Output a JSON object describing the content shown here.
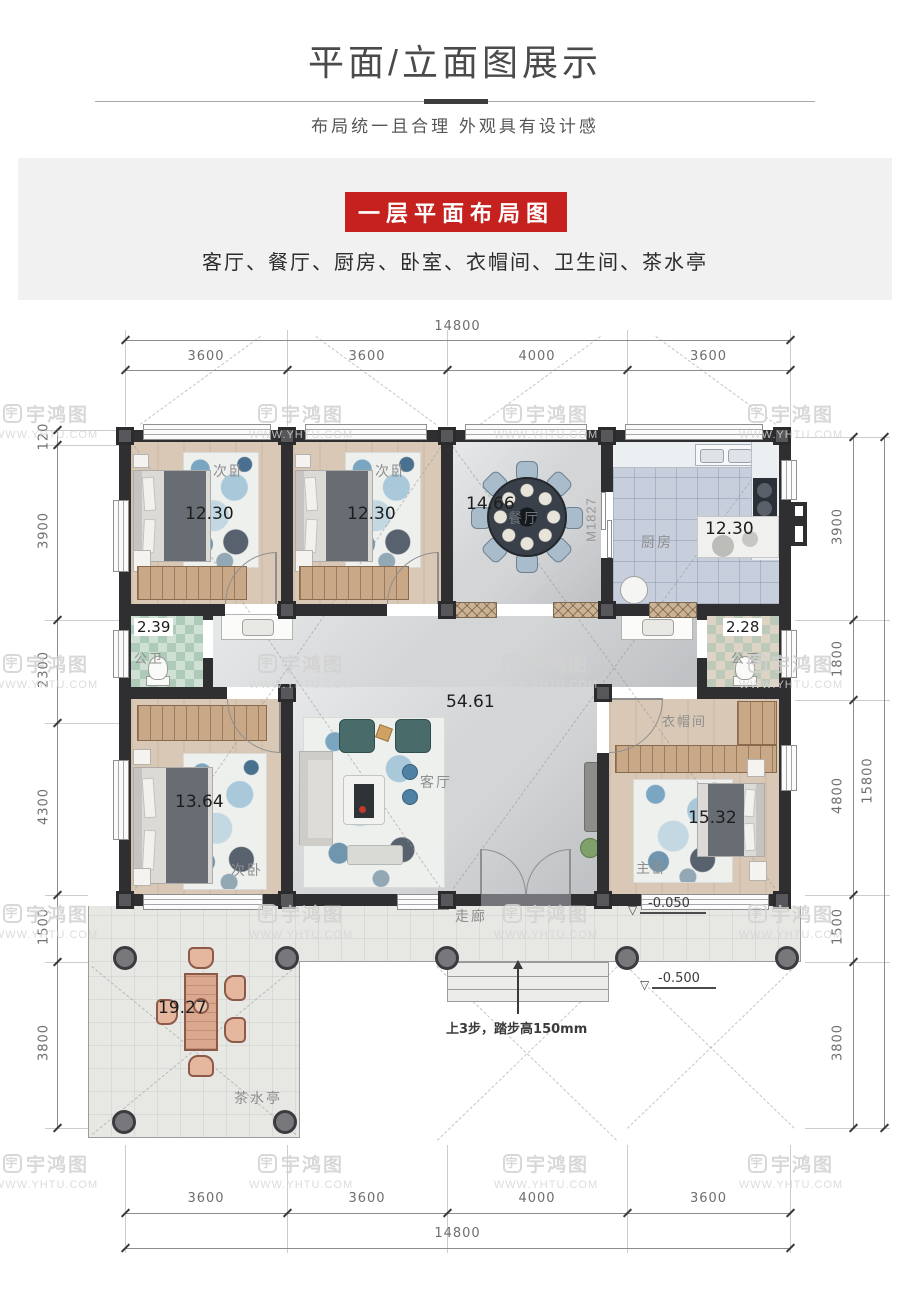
{
  "header": {
    "title": "平面/立面图展示",
    "subtitle": "布局统一且合理 外观具有设计感",
    "banner": "一层平面布局图",
    "room_list": "客厅、餐厅、厨房、卧室、衣帽间、卫生间、茶水亭"
  },
  "watermark": {
    "icon_char": "宇",
    "logo": "宇鸿图",
    "url": "WWW.YHTU.COM"
  },
  "dims": {
    "top": {
      "overall": "14800",
      "segments": [
        "3600",
        "3600",
        "4000",
        "3600"
      ]
    },
    "bottom": {
      "overall": "14800",
      "segments": [
        "3600",
        "3600",
        "4000",
        "3600"
      ]
    },
    "left": {
      "segments": [
        "120",
        "3900",
        "2300",
        "4300",
        "1500",
        "3800"
      ]
    },
    "right": {
      "segments": [
        "3900",
        "1800",
        "4800",
        "1500",
        "3800"
      ],
      "overall": "15800"
    }
  },
  "rooms": {
    "bedroom_a": {
      "name": "次卧",
      "area": "12.30"
    },
    "bedroom_b": {
      "name": "次卧",
      "area": "12.30"
    },
    "dining": {
      "name": "餐厅",
      "area": "14.66"
    },
    "kitchen": {
      "name": "厨房",
      "area": "12.30"
    },
    "bath_left": {
      "name": "公卫",
      "area": "2.39"
    },
    "bath_right": {
      "name": "公卫",
      "area": "2.28"
    },
    "living": {
      "name": "客厅",
      "area": "54.61"
    },
    "bedroom_c": {
      "name": "次卧",
      "area": "13.64"
    },
    "cloakroom": {
      "name": "衣帽间"
    },
    "master": {
      "name": "主卧",
      "area": "15.32"
    },
    "corridor": {
      "name": "走廊"
    },
    "tea_pavilion": {
      "name": "茶水亭",
      "area": "19.27"
    }
  },
  "annotations": {
    "door_code": "M1827",
    "level_porch": "-0.050",
    "level_ground": "-0.500",
    "level_symbol": "▽",
    "steps_note": "上3步，踏步高150mm"
  },
  "colors": {
    "accent_red": "#c5211e",
    "wall": "#2f2f31"
  }
}
